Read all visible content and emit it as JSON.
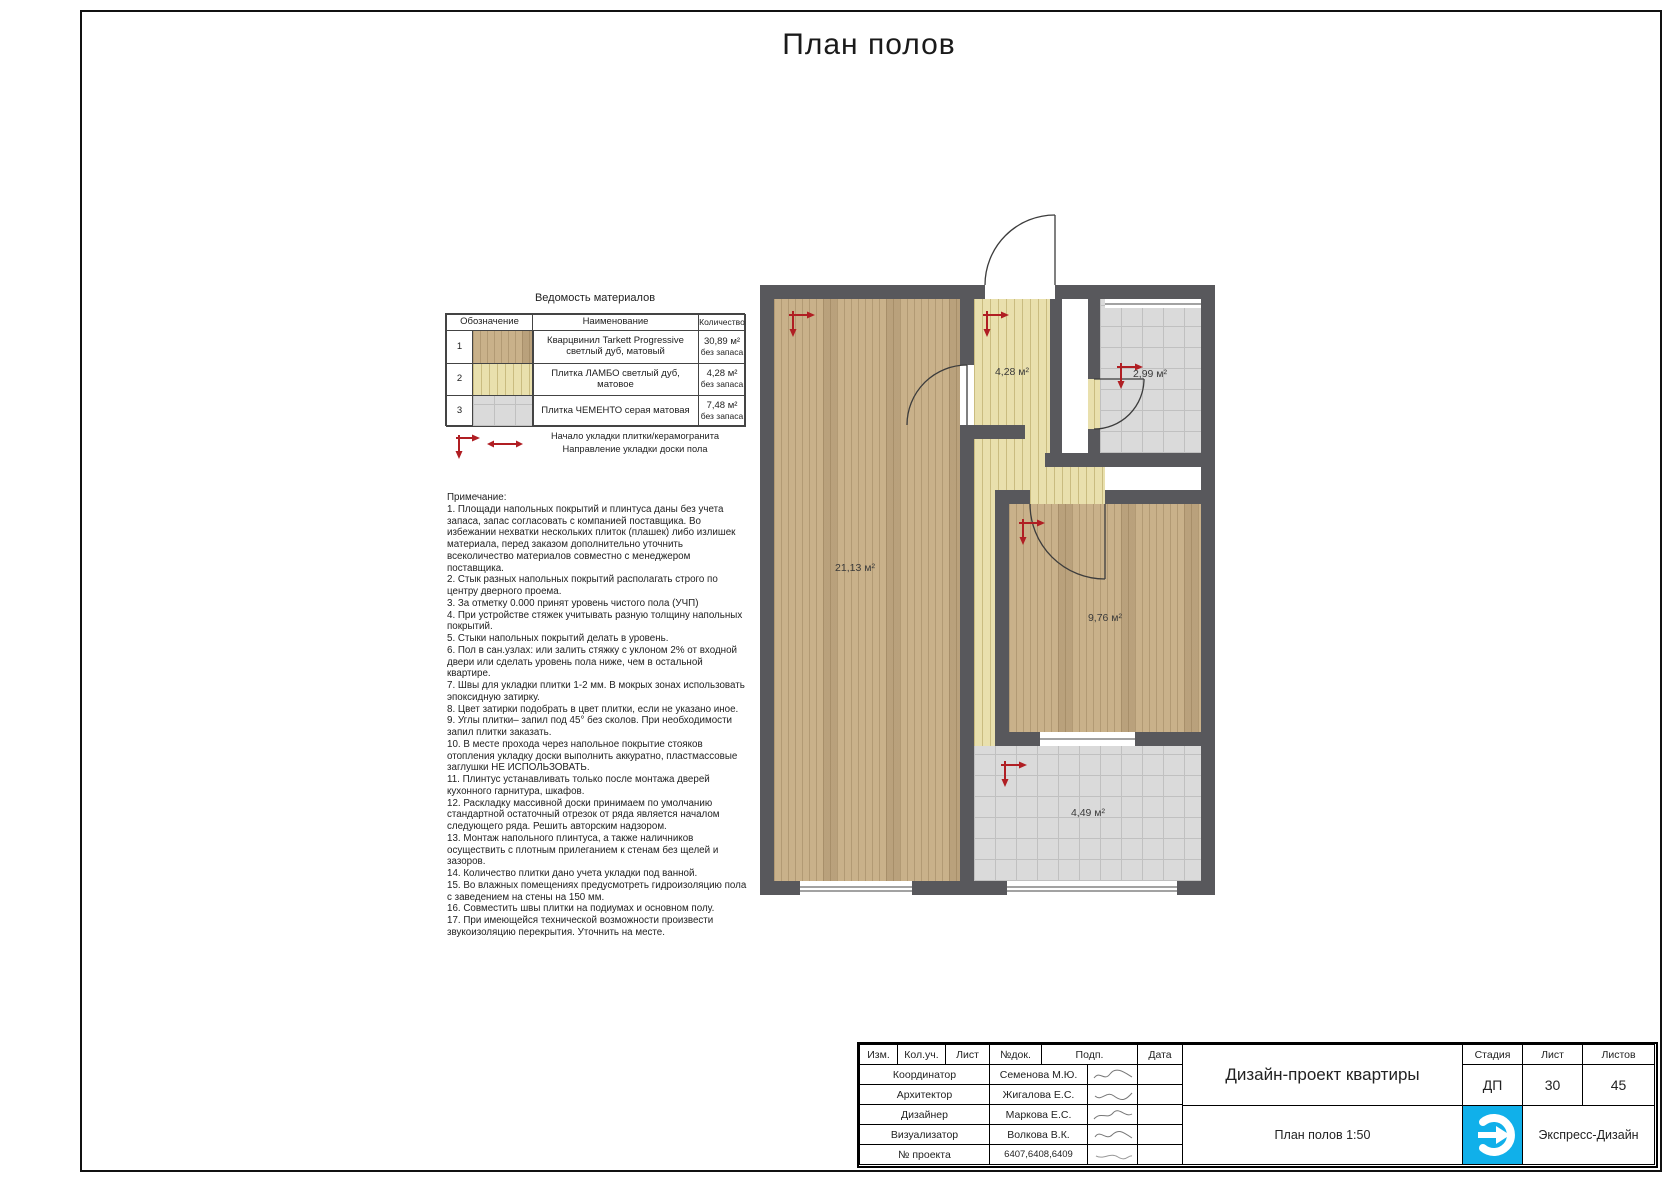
{
  "sheet": {
    "title": "План полов"
  },
  "materials_table": {
    "title": "Ведомость материалов",
    "headers": {
      "designation": "Обозначение",
      "name": "Наименование",
      "qty": "Количество"
    },
    "rows": [
      {
        "num": "1",
        "name": "Кварцвинил Tarkett Progressive светлый дуб, матовый",
        "qty": "30,89 м²",
        "qty_note": "без запаса",
        "swatch": "wood"
      },
      {
        "num": "2",
        "name": "Плитка ЛАМБО светлый дуб, матовое",
        "qty": "4,28 м²",
        "qty_note": "без запаса",
        "swatch": "tile-yellow"
      },
      {
        "num": "3",
        "name": "Плитка ЧЕМЕНТО серая матовая",
        "qty": "7,48 м²",
        "qty_note": "без запаса",
        "swatch": "tile-gray"
      }
    ],
    "legend": [
      "Начало укладки плитки/керамогранита",
      "Направление укладки доски пола"
    ]
  },
  "notes": {
    "title": "Примечание:",
    "items": [
      "1. Площади напольных покрытий и плинтуса даны без учета запаса, запас согласовать с компанией поставщика. Во избежании нехватки нескольких плиток (плашек) либо излишек материала, перед заказом дополнительно уточнить всеколичество материалов совместно с менеджером поставщика.",
      "2. Стык разных напольных покрытий располагать строго по центру дверного проема.",
      "3. За отметку 0.000 принят уровень чистого пола (УЧП)",
      "4. При устройстве стяжек учитывать разную толщину напольных покрытий.",
      "5. Стыки напольных покрытий делать в уровень.",
      "6. Пол в сан.узлах: или залить стяжку с уклоном 2% от входной двери или сделать уровень пола ниже, чем в остальной квартире.",
      "7. Швы для укладки плитки 1-2 мм. В мокрых зонах использовать эпоксидную затирку.",
      "8. Цвет затирки подобрать в цвет плитки, если не указано иное.",
      "9. Углы плитки– запил под 45° без сколов. При необходимости запил плитки заказать.",
      "10. В месте прохода через напольное покрытие стояков отопления укладку доски выполнить аккуратно, пластмассовые заглушки НЕ ИСПОЛЬЗОВАТЬ.",
      "11. Плинтус устанавливать только после монтажа дверей кухонного гарнитура, шкафов.",
      "12. Раскладку массивной доски принимаем по умолчанию стандартной остаточный отрезок от ряда является началом следующего ряда. Решить авторским надзором.",
      "13. Монтаж напольного плинтуса, а также наличников осуществить с плотным прилеганием к стенам без щелей и зазоров.",
      "14. Количество плитки дано учета укладки под ванной.",
      "15. Во влажных помещениях предусмотреть гидроизоляцию пола с заведением на стены на 150 мм.",
      "16. Совместить швы плитки на подиумах и основном полу.",
      "17. При имеющейся технической возможности произвести звукоизоляцию перекрытия. Уточнить на месте."
    ]
  },
  "plan": {
    "rooms": [
      {
        "name": "living-room",
        "area_label": "21,13 м²",
        "floor": "quartz-vinyl"
      },
      {
        "name": "hallway",
        "area_label": "4,28 м²",
        "floor": "tile-lambo"
      },
      {
        "name": "bathroom",
        "area_label": "2,99 м²",
        "floor": "tile-cemento"
      },
      {
        "name": "bedroom",
        "area_label": "9,76 м²",
        "floor": "quartz-vinyl"
      },
      {
        "name": "balcony-room",
        "area_label": "4,49 м²",
        "floor": "tile-cemento"
      }
    ],
    "colors": {
      "wall": "#58585c",
      "wood": "#c9b18a",
      "tile_yellow": "#e9e0ad",
      "tile_gray": "#dadada",
      "marker_red": "#b01e23"
    }
  },
  "titleblock": {
    "header_cells": [
      "Изм.",
      "Кол.уч.",
      "Лист",
      "№док.",
      "Подп.",
      "Дата"
    ],
    "rows": [
      {
        "role": "Координатор",
        "name": "Семенова М.Ю."
      },
      {
        "role": "Архитектор",
        "name": "Жигалова Е.С."
      },
      {
        "role": "Дизайнер",
        "name": "Маркова Е.С."
      },
      {
        "role": "Визуализатор",
        "name": "Волкова В.К."
      },
      {
        "role": "№ проекта",
        "name": "6407,6408,6409"
      }
    ],
    "project_title": "Дизайн-проект квартиры",
    "sheet_title": "План полов 1:50",
    "stage_header": "Стадия",
    "sheet_header": "Лист",
    "sheets_header": "Листов",
    "stage": "ДП",
    "sheet_num": "30",
    "sheets_total": "45",
    "company": "Экспресс-Дизайн",
    "logo_color": "#10b0ea"
  }
}
